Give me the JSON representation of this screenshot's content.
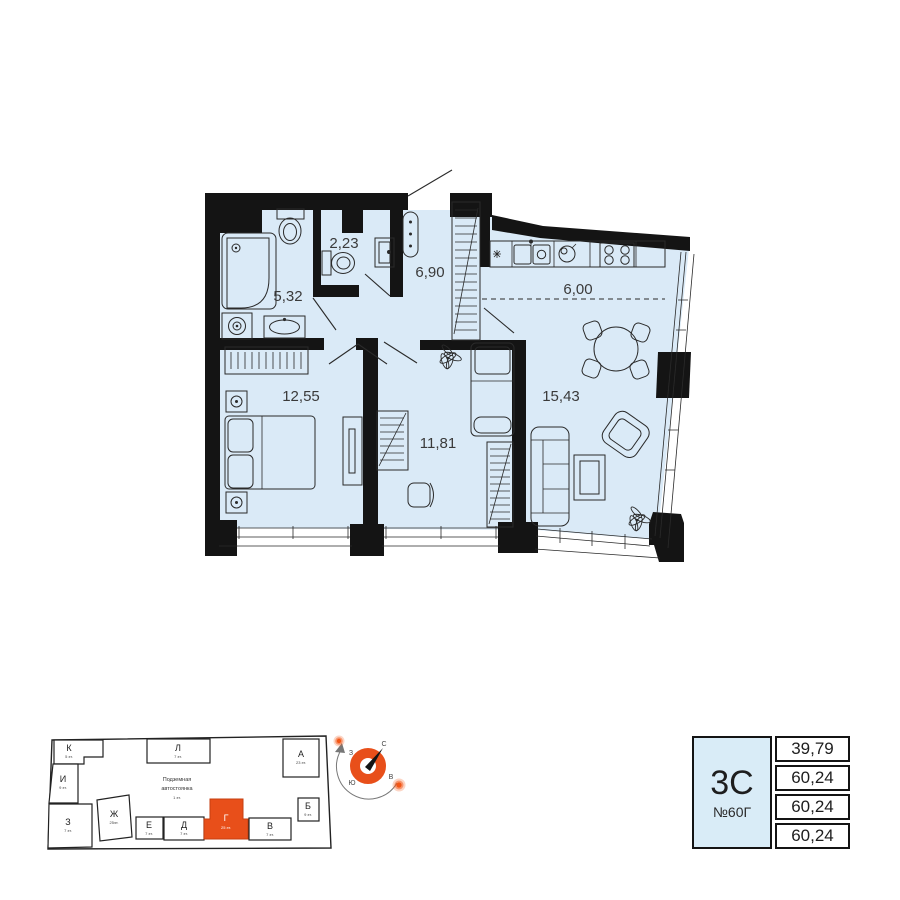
{
  "colors": {
    "accent": "#e84f1a",
    "floor_fill": "#daeaf7",
    "wall": "#141414",
    "card_fill": "#d9ecf7"
  },
  "floor_plan": {
    "rooms": [
      {
        "name": "bathroom",
        "area": "5,32"
      },
      {
        "name": "wc",
        "area": "2,23"
      },
      {
        "name": "hall",
        "area": "6,90"
      },
      {
        "name": "kitchen",
        "area": "6,00"
      },
      {
        "name": "living-room",
        "area": "15,43"
      },
      {
        "name": "bedroom",
        "area": "12,55"
      },
      {
        "name": "room",
        "area": "11,81"
      }
    ]
  },
  "site_plan": {
    "parking_line1": "Подземная",
    "parking_line2": "автостоянка",
    "parking_floors": "1 эт.",
    "highlighted_section": "Г",
    "sections": [
      {
        "letter": "К",
        "floors": "5 эт."
      },
      {
        "letter": "И",
        "floors": "9 эт."
      },
      {
        "letter": "З",
        "floors": "7 эт."
      },
      {
        "letter": "Ж",
        "floors": "25эт."
      },
      {
        "letter": "Е",
        "floors": "7 эт."
      },
      {
        "letter": "Д",
        "floors": "7 эт."
      },
      {
        "letter": "Г",
        "floors": "25 эт."
      },
      {
        "letter": "В",
        "floors": "7 эт."
      },
      {
        "letter": "Б",
        "floors": "9 эт."
      },
      {
        "letter": "А",
        "floors": "23 эт."
      },
      {
        "letter": "Л",
        "floors": "7 эт."
      }
    ]
  },
  "compass": {
    "north": "С",
    "east": "В",
    "south": "Ю",
    "west": "З"
  },
  "info_card": {
    "plan_type": "3С",
    "apartment_number": "№60Г",
    "rows": [
      "39,79",
      "60,24",
      "60,24",
      "60,24"
    ]
  }
}
